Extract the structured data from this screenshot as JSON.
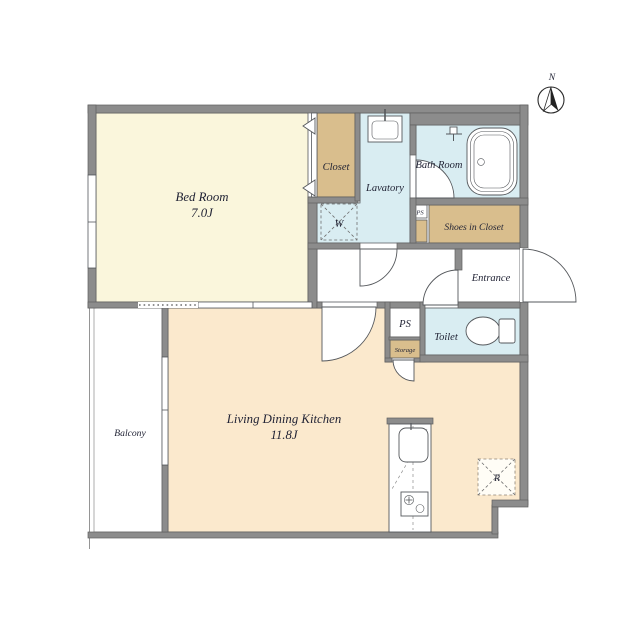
{
  "colors": {
    "wall": "#8c8c8c",
    "wall_edge": "#5e5e5e",
    "line": "#55585c",
    "text": "#1f2133",
    "room_bedroom": "#faf6dc",
    "room_ldk": "#fbe9cd",
    "room_wet": "#d9edf2",
    "room_tan": "#d9be8d"
  },
  "rooms": {
    "bedroom": {
      "name": "Bed Room",
      "size": "7.0J"
    },
    "ldk": {
      "name": "Living Dining Kitchen",
      "size": "11.8J"
    },
    "closet": {
      "name": "Closet"
    },
    "lavatory": {
      "name": "Lavatory"
    },
    "bathroom": {
      "name": "Bath Room"
    },
    "shoes": {
      "name": "Shoes in Closet"
    },
    "entrance": {
      "name": "Entrance"
    },
    "toilet": {
      "name": "Toilet"
    },
    "balcony": {
      "name": "Balcony"
    },
    "storage": {
      "name": "Storage"
    }
  },
  "labels": {
    "ps_upper": "PS",
    "ps_lower": "PS",
    "washer": "W",
    "refrigerator": "R",
    "north": "N"
  }
}
